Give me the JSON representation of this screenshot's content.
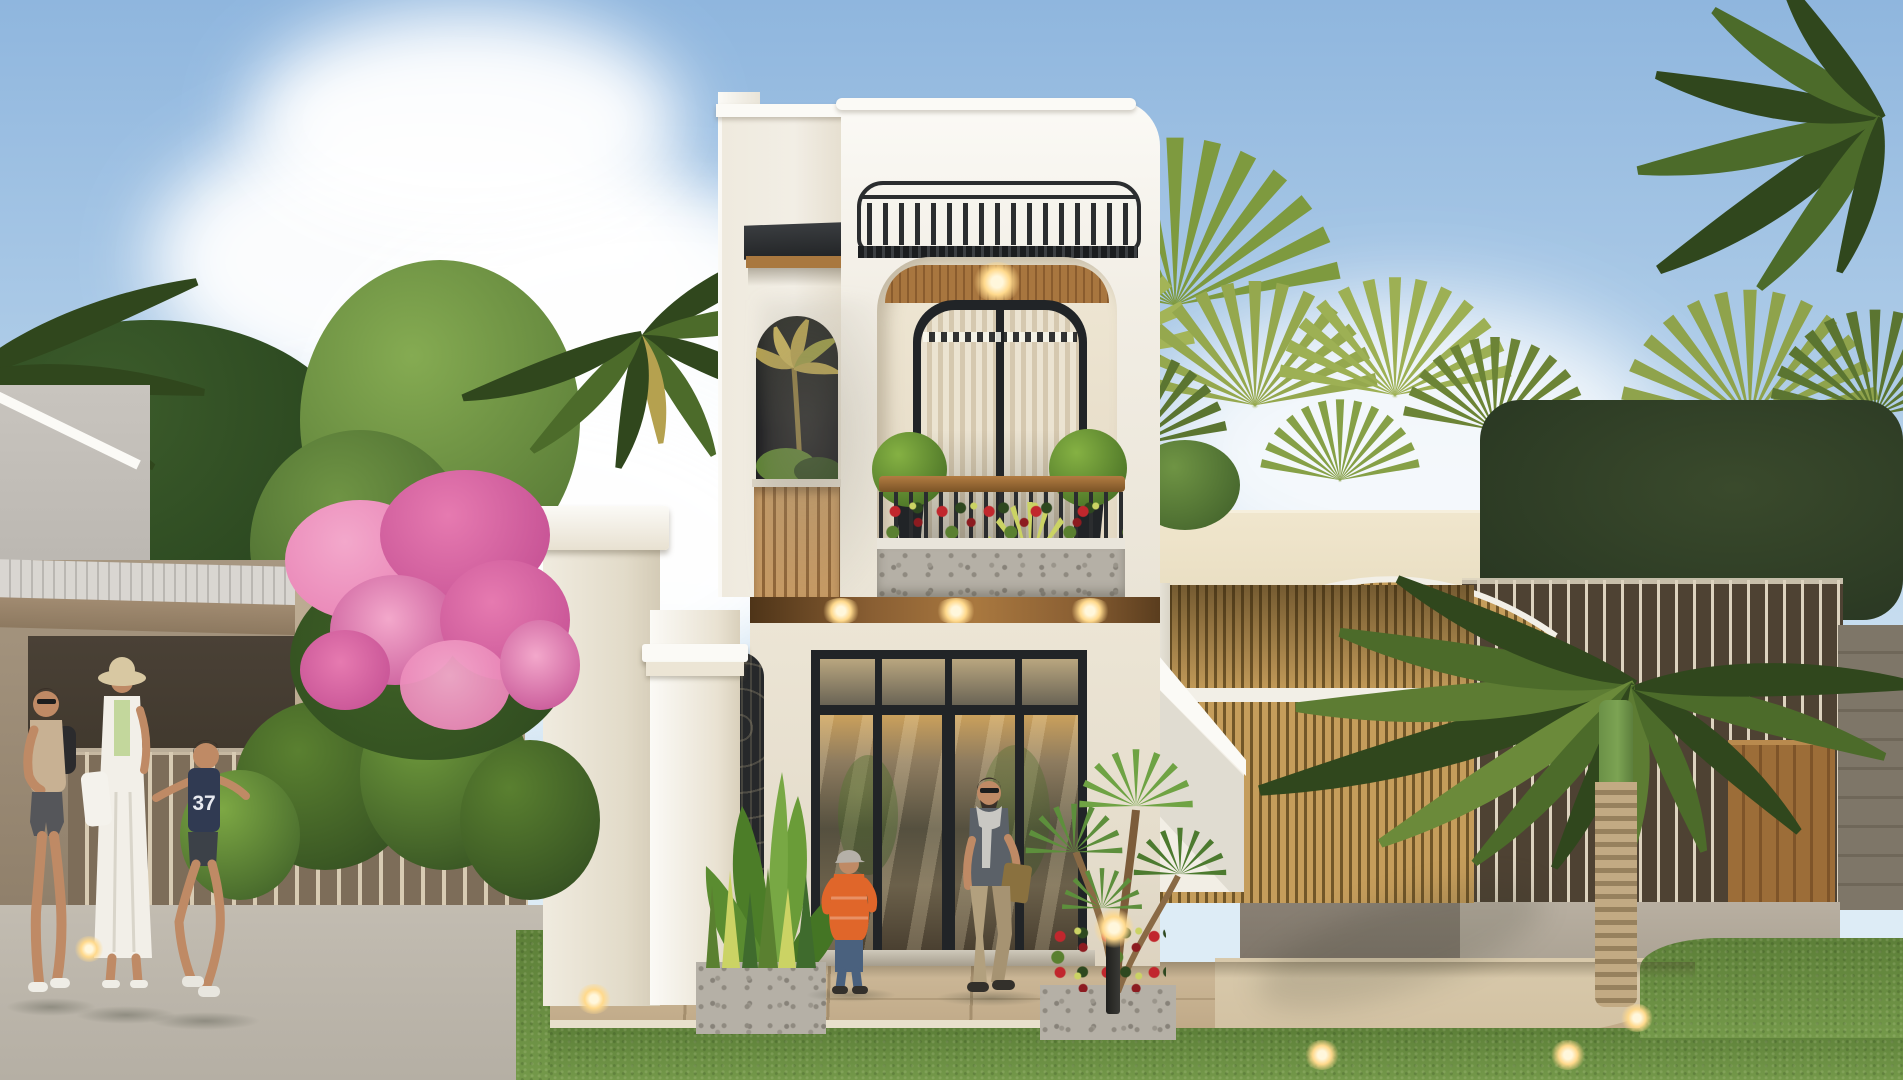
{
  "meta": {
    "type": "architectural-exterior-render",
    "description": "Daytime 3D rendering of a narrow two-storey modern white townhouse with arched black-framed windows, a planted balcony with red flowers and topiary balls, a rooftop black metal railing, wood slat accents, a classical white gate pillar with wrought-iron arched gate, pink bougainvillea, tropical palms, neighbouring houses on both sides and people walking on the sidewalk.",
    "canvas": {
      "width": 1903,
      "height": 1080
    }
  },
  "palette": {
    "sky-top": "#8fb6de",
    "sky-mid": "#b5d1ea",
    "sky-low": "#ddecf6",
    "cloud": "#ffffff",
    "white-hi": "#fbfaf6",
    "white": "#f2eee5",
    "white-shade": "#dcd5c6",
    "warm-wall": "#ece5d5",
    "frame-dark": "#212427",
    "rail-dark": "#2b2d2f",
    "wood": "#a9783f",
    "wood-dark": "#7a5326",
    "slat-light": "#c79a63",
    "slat-gap": "#8f6436",
    "recess": "#e3d8c3",
    "curtain-a": "#ebe3d1",
    "curtain-b": "#d5c8af",
    "glass-warm": "#8d7b5f",
    "glass-dark": "#3f3d36",
    "topiary-hi": "#85b143",
    "topiary-lo": "#3e6520",
    "red": "#c1272d",
    "red-dark": "#8c1b20",
    "yellowgreen": "#cbd364",
    "pink": "#e67ab0",
    "pink-deep": "#c14b90",
    "pink-light": "#f3a8cb",
    "leaf": "#5a8030",
    "leaf-dark": "#2e481f",
    "palm": "#4c6b2a",
    "palm-dark": "#30471d",
    "palm-gold": "#b5a14f",
    "lawn": "#74994a",
    "lawn-dark": "#5c7f38",
    "pavement": "#b5afa4",
    "paver": "#c7b394",
    "paver-joint": "#a58f6e",
    "edging": "#e8e0cc",
    "driveway": "#d2c1a2",
    "tan-wall": "#b1a189",
    "gable": "#c8c4be",
    "awning": "#d9d6d1",
    "awning-rib": "#bab7b2",
    "fascia": "#a18b71",
    "porch": "#40382d",
    "fence-bg": "#7d6d59",
    "fence-bar": "#d8cbb3",
    "cream": "#e9dec2",
    "trellis-slat": "#c59d5b",
    "trellis-dark": "#715628",
    "trellis-frame": "#f2efe7",
    "rfence-bg": "#4e4233",
    "rfence-bar": "#ddd3bf",
    "wood-gate": "#9c6d38",
    "stone": "#7e7668",
    "planter": "#b5b0a6",
    "planter-cap": "#e9e5db",
    "glow": "#ffd98c",
    "glow-core": "#fff7dc",
    "trunk-wrap": "#c2aa83",
    "trunk-wrap-dark": "#97815d",
    "trunk-green": "#7ca353",
    "skin": "#bf8a65",
    "hair": "#3a3028",
    "shirt-tan": "#c8b193",
    "shorts-gray": "#55565a",
    "dress-white": "#f2efe8",
    "hat-straw": "#d8c8a2",
    "top-green": "#c3d79c",
    "bag-white": "#f4f2ec",
    "boy-shirt": "#303a52",
    "kid-orange": "#e0662a",
    "jeans": "#4a617e",
    "cap-gray": "#b5b0a8",
    "polo-gray": "#5b6168",
    "scarf-gray": "#c9c8c3",
    "khaki": "#b2a07e",
    "bag-brown": "#8a713f",
    "shoe-dark": "#33302b",
    "shadow": "rgba(45,50,38,0.30)"
  },
  "scene": {
    "people": {
      "count": 5,
      "boy_shirt_number": "37",
      "labels": [
        "man walking with backpack",
        "woman in white dress with straw hat",
        "running boy with 37 shirt",
        "child in orange jacket",
        "man with scarf carrying parcel"
      ]
    },
    "objects": [
      "blue sky with cumulus clouds",
      "coconut palms",
      "fan palms",
      "left neighbour house with striped awning and bar fence",
      "pink bougainvillea bush",
      "white two-storey townhouse",
      "rooftop black railing and louvred pergola",
      "arched black framed window with curtains",
      "balcony with wood handrail, topiary balls and red flowers",
      "stone flower planter",
      "wood soffit with downlights",
      "glass entrance doors",
      "white gate pillar with cornice",
      "wrought iron arched gate",
      "banana plant",
      "sansevieria planter",
      "dracaena planter with bollard light",
      "sloped white boundary wall",
      "neighbour arched slat trellis gate",
      "gold slat fence",
      "dark fence with light bars",
      "wooden side gate",
      "stone pillar",
      "green lawn with garden lights",
      "paved walkway and driveway"
    ]
  }
}
